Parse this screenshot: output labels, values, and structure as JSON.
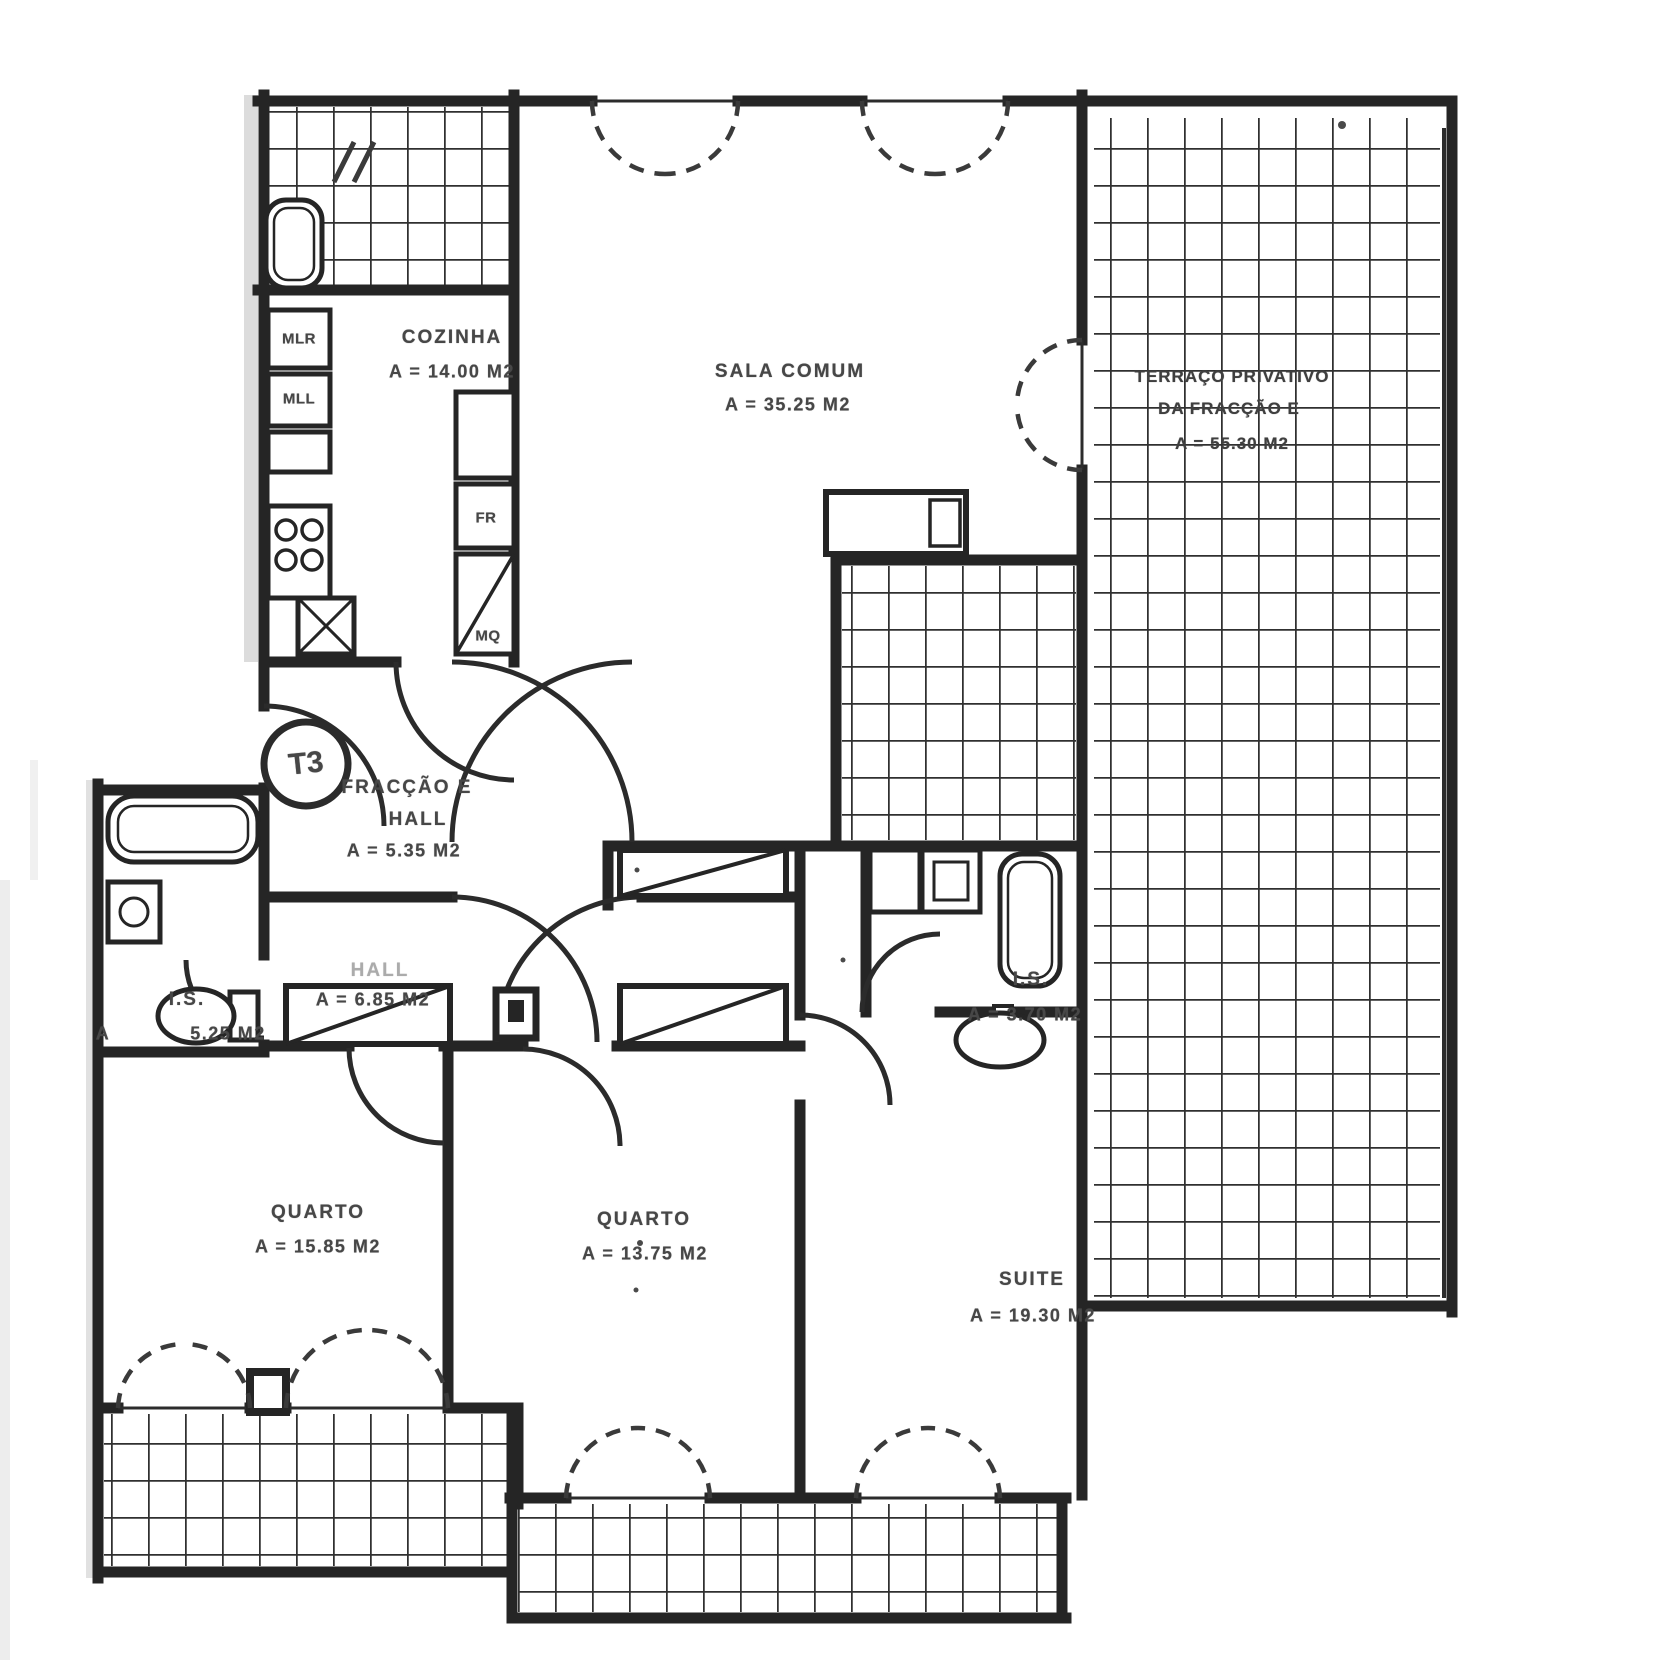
{
  "document": {
    "kind": "scanned apartment floor plan",
    "unit_badge": "T3"
  },
  "colors": {
    "ink": "#252525",
    "label_ink": "#474747",
    "paper": "#ffffff",
    "tile_grid": "#303030",
    "smudge": "#9a9a9a"
  },
  "rooms": {
    "cozinha": {
      "name": "COZINHA",
      "area": "A = 14.00 M2"
    },
    "sala": {
      "name": "SALA COMUM",
      "area": "A = 35.25 M2"
    },
    "terraco": {
      "line1": "TERRAÇO PRIVATIVO",
      "line2": "DA FRACÇÃO E",
      "area": "A = 55.30 M2"
    },
    "entrada": {
      "fraction": "FRACÇÃO E",
      "name": "HALL",
      "area": "A = 5.35 M2"
    },
    "hall": {
      "name": "HALL",
      "area": "A = 6.85 M2"
    },
    "is_esq": {
      "name": "I.S.",
      "prefix": "A",
      "area": "5.25 M2"
    },
    "is_suite": {
      "name": "I.S.",
      "area": "A = 3.70 M2"
    },
    "quarto_1": {
      "name": "QUARTO",
      "area": "A = 15.85 M2"
    },
    "quarto_2": {
      "name": "QUARTO",
      "area": "A = 13.75 M2"
    },
    "suite": {
      "name": "SUITE",
      "area": "A = 19.30 M2"
    }
  },
  "kitchen_fixtures": {
    "mlr": "MLR",
    "mll": "MLL",
    "fr": "FR",
    "mq": "MQ"
  }
}
